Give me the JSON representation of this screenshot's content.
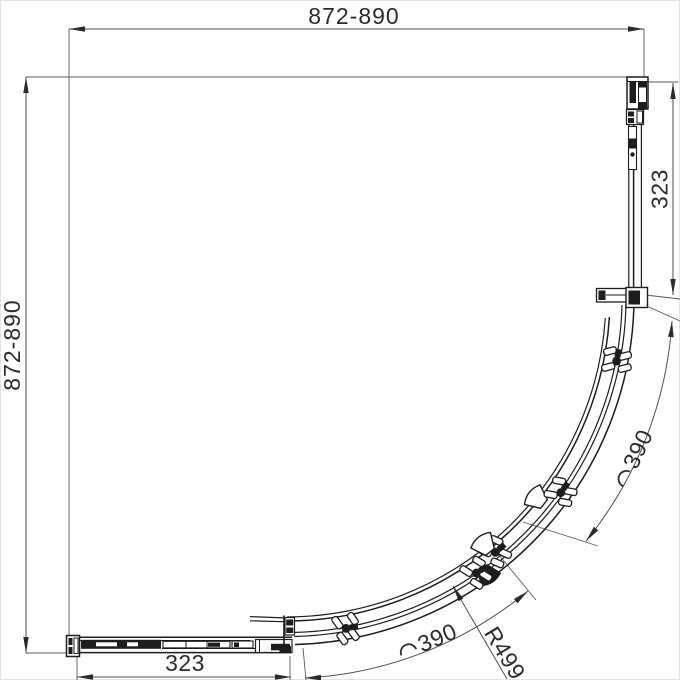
{
  "drawing": {
    "dimensions": {
      "top": "872-890",
      "left": "872-890",
      "right_side": "323",
      "bottom": "323",
      "arc_upper": "390",
      "arc_lower": "390",
      "radius": "R499"
    },
    "colors": {
      "background": "#ffffff",
      "object_line": "#1d1d1d",
      "dimension_line": "#4f4f4f",
      "text": "#2b2b2b"
    }
  }
}
